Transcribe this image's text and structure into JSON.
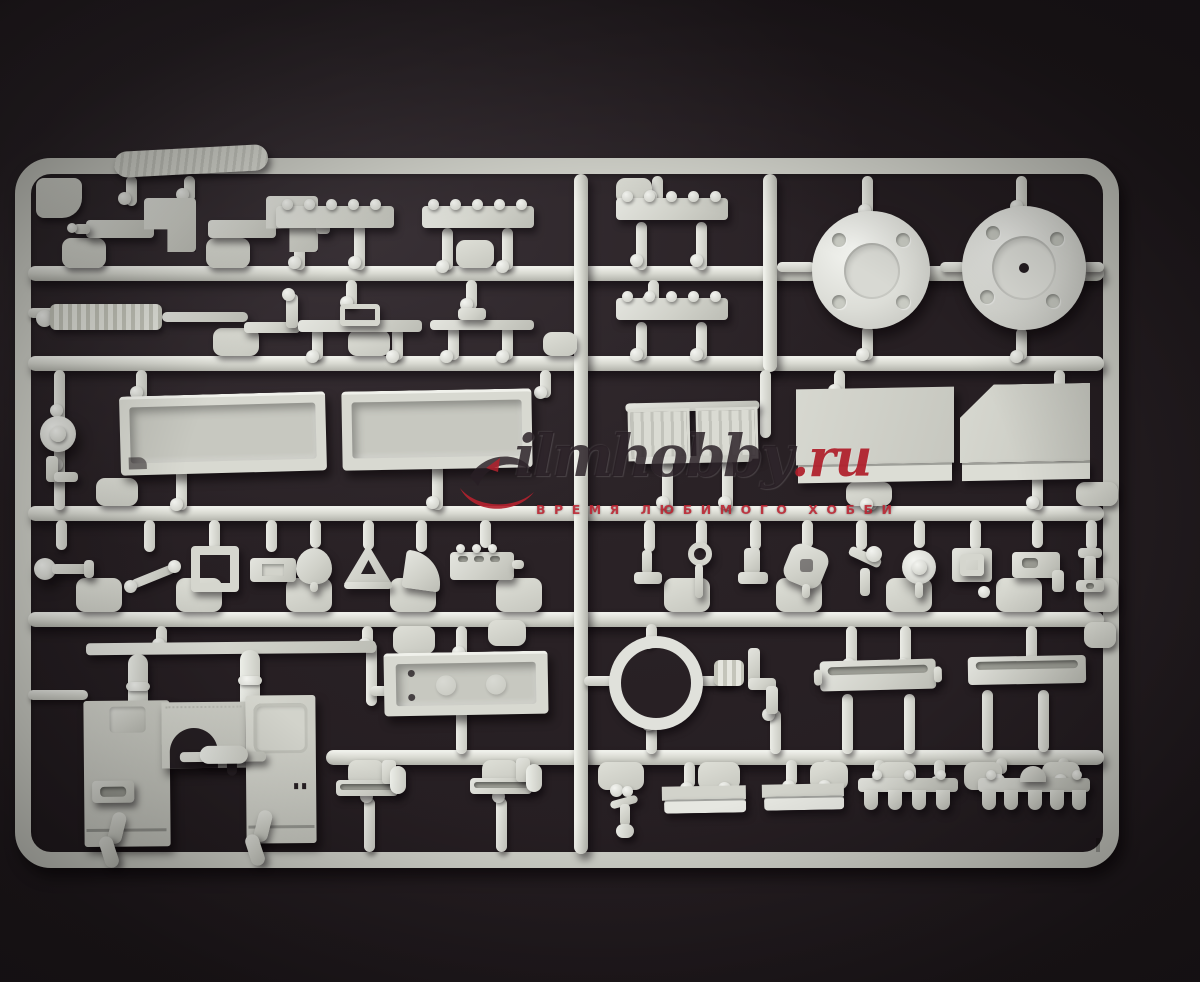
{
  "photo": {
    "subject": "light grey injection-molded plastic model kit sprue with vehicle parts on dark fabric"
  },
  "watermark": {
    "brand_script": "ilmhobby",
    "brand_tld": ".ru",
    "tagline": "ВРЕМЯ ЛЮБИМОГО ХОББИ",
    "logo": "red-swoosh-logo"
  },
  "colors": {
    "background": "#272024",
    "background_edge": "#171215",
    "sprue": "#d6d7d0",
    "sprue_highlight": "#eff0ea",
    "sprue_shadow": "#a9aaa2",
    "watermark_red": "#b7242f",
    "watermark_dark": "#332931"
  }
}
